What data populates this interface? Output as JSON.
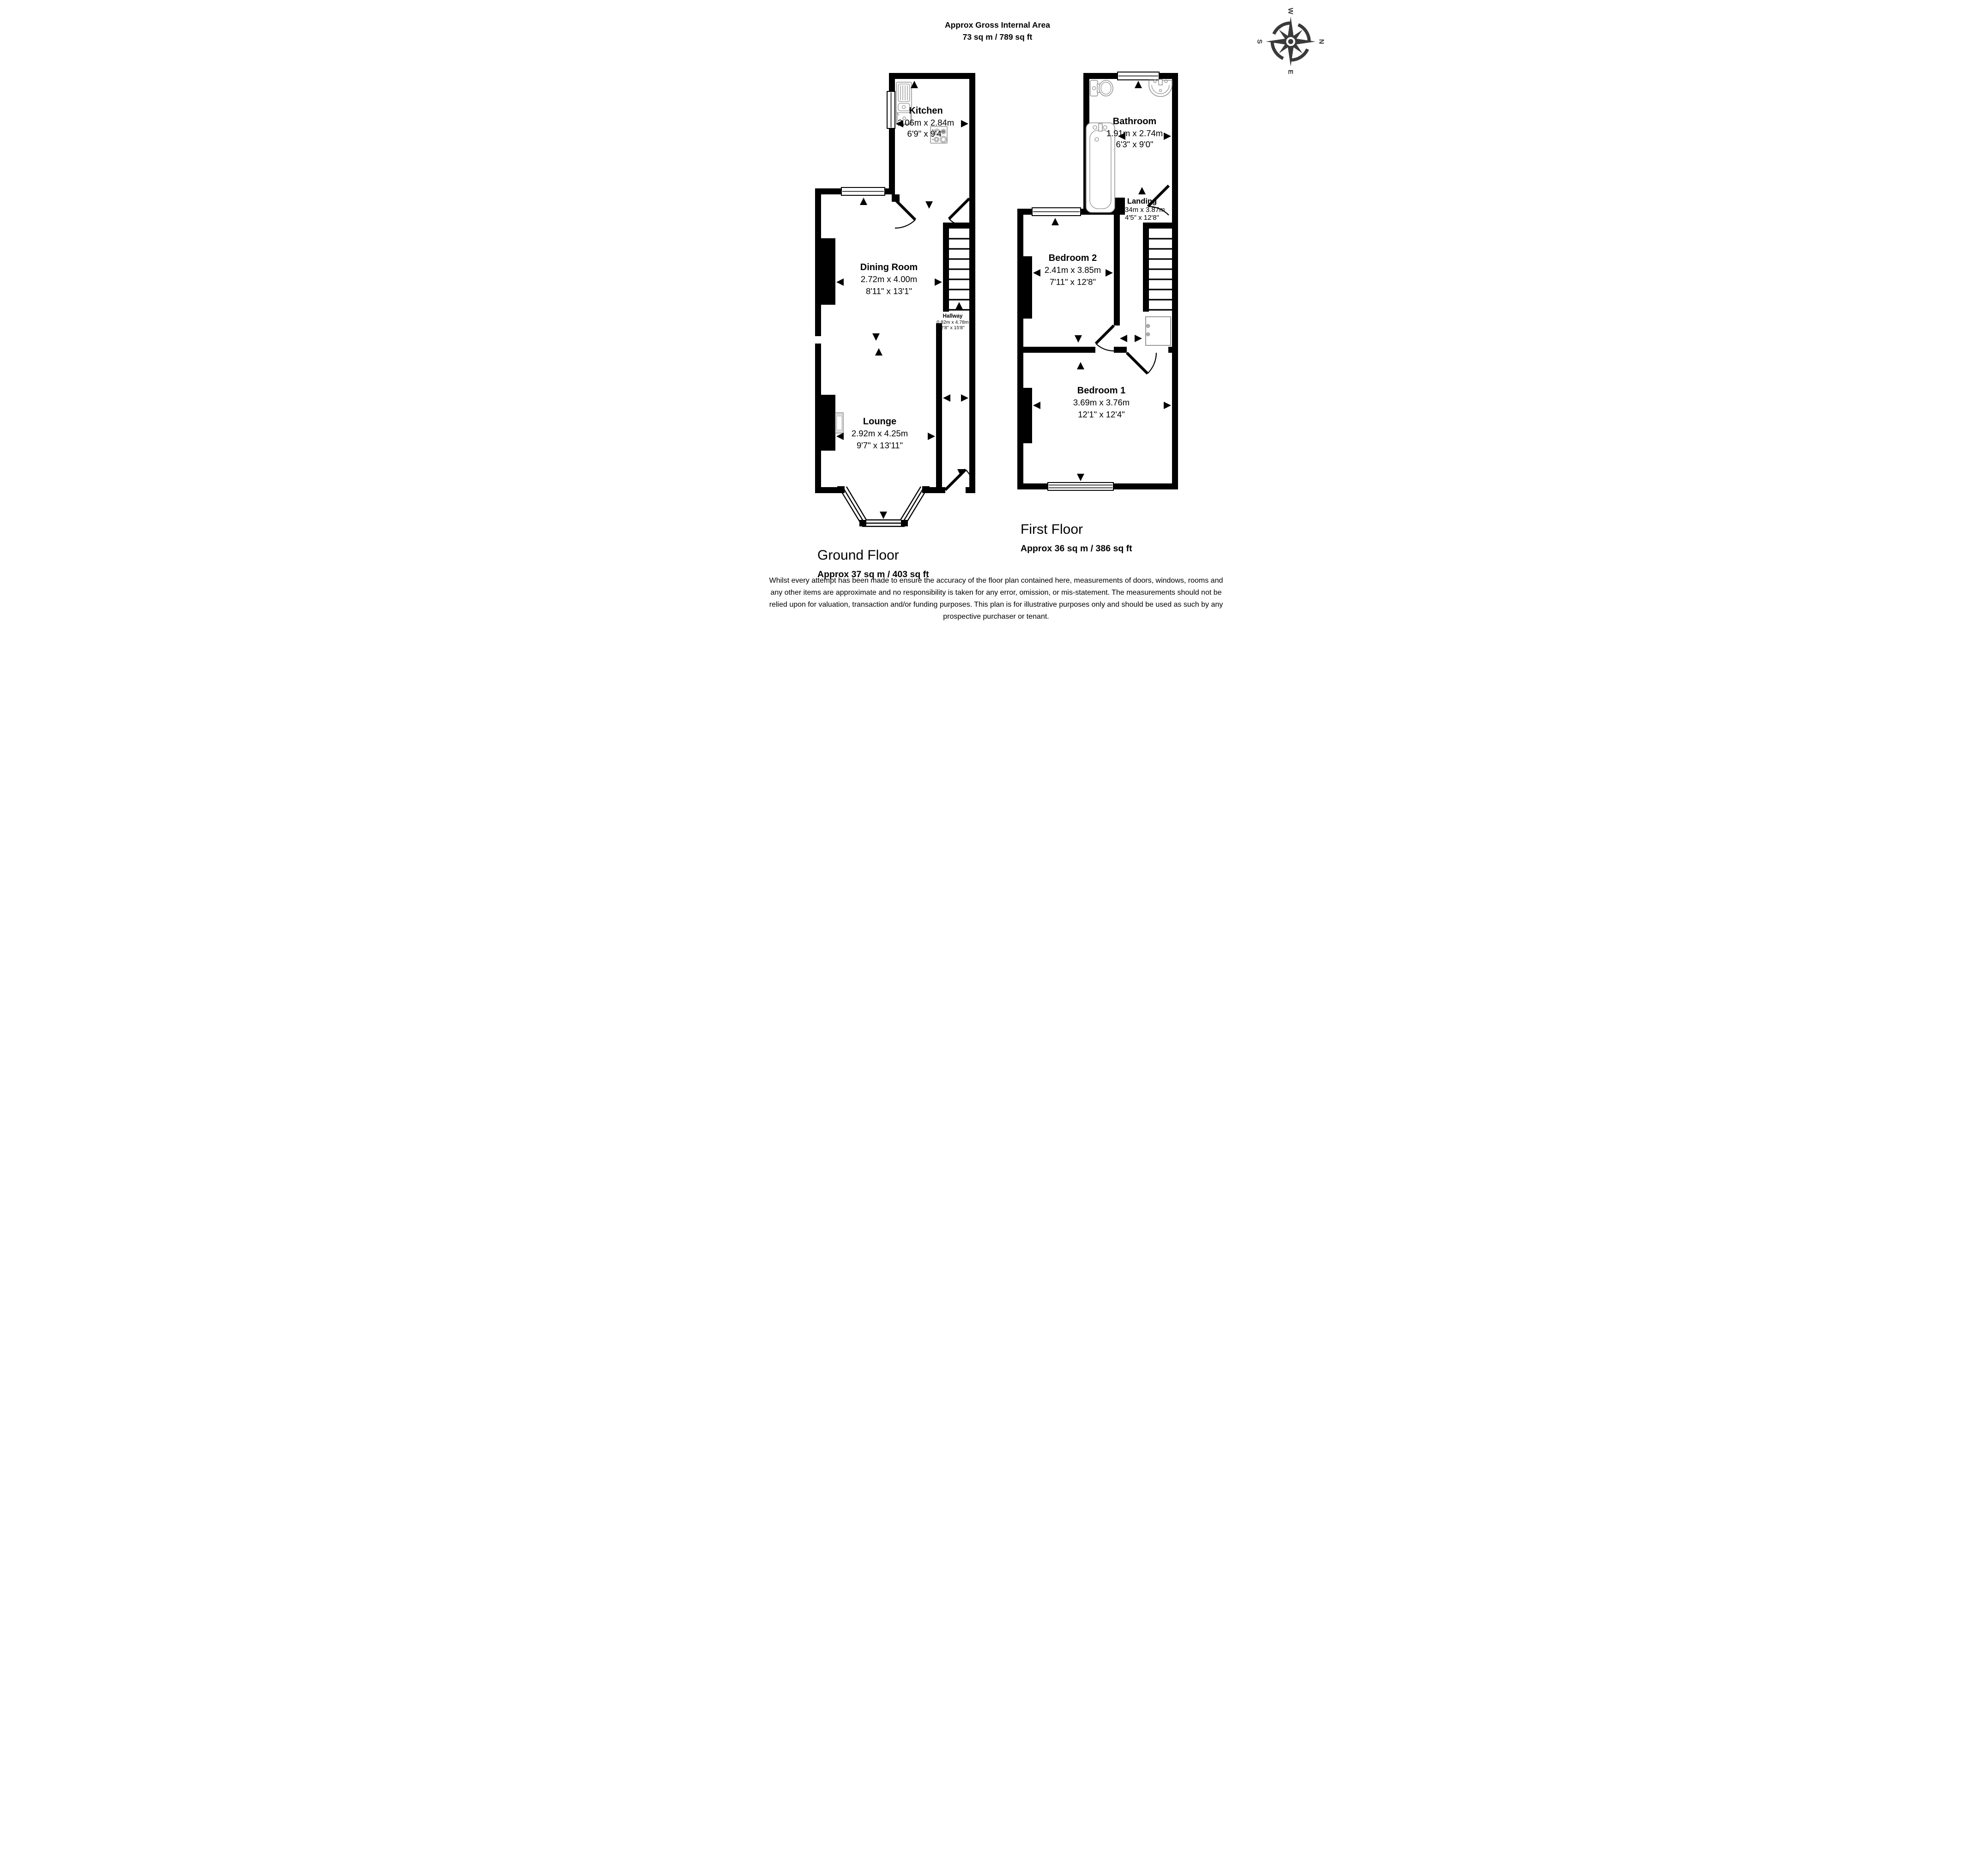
{
  "title": {
    "line1": "Approx Gross Internal Area",
    "line2": "73 sq m / 789 sq ft"
  },
  "compass": {
    "n": "N",
    "e": "E",
    "s": "S",
    "w": "W"
  },
  "floors": {
    "ground": {
      "label": "Ground Floor",
      "area": "Approx 37 sq m / 403 sq ft",
      "rooms": {
        "kitchen": {
          "name": "Kitchen",
          "metric": "2.06m x 2.84m",
          "imperial": "6'9\" x 9'4\""
        },
        "dining": {
          "name": "Dining Room",
          "metric": "2.72m x 4.00m",
          "imperial": "8'11\" x 13'1\""
        },
        "hallway": {
          "name": "Hallway",
          "metric": "0.82m x 4.78m",
          "imperial": "2'8\" x 15'8\""
        },
        "lounge": {
          "name": "Lounge",
          "metric": "2.92m x 4.25m",
          "imperial": "9'7\" x 13'11\""
        }
      }
    },
    "first": {
      "label": "First Floor",
      "area": "Approx 36 sq m / 386 sq ft",
      "rooms": {
        "bathroom": {
          "name": "Bathroom",
          "metric": "1.91m x 2.74m",
          "imperial": "6'3\" x 9'0\""
        },
        "landing": {
          "name": "Landing",
          "metric": "1.34m x 3.87m",
          "imperial": "4'5\" x 12'8\""
        },
        "bedroom2": {
          "name": "Bedroom 2",
          "metric": "2.41m x 3.85m",
          "imperial": "7'11\" x 12'8\""
        },
        "bedroom1": {
          "name": "Bedroom 1",
          "metric": "3.69m x 3.76m",
          "imperial": "12'1\" x 12'4\""
        }
      }
    }
  },
  "disclaimer": {
    "line1": "Whilst every attempt has been made to ensure the accuracy of the floor plan contained here, measurements of doors, windows, rooms and",
    "line2": "any other items are approximate and no responsibility is taken for any error, omission, or mis-statement. The measurements should not be",
    "line3": "relied upon for valuation, transaction and/or funding purposes. This plan is for illustrative purposes only and should be used as such by any",
    "line4": "prospective purchaser or tenant."
  },
  "colors": {
    "wall": "#000000",
    "compass": "#3a3a3a",
    "fixture_outline": "#909090"
  }
}
